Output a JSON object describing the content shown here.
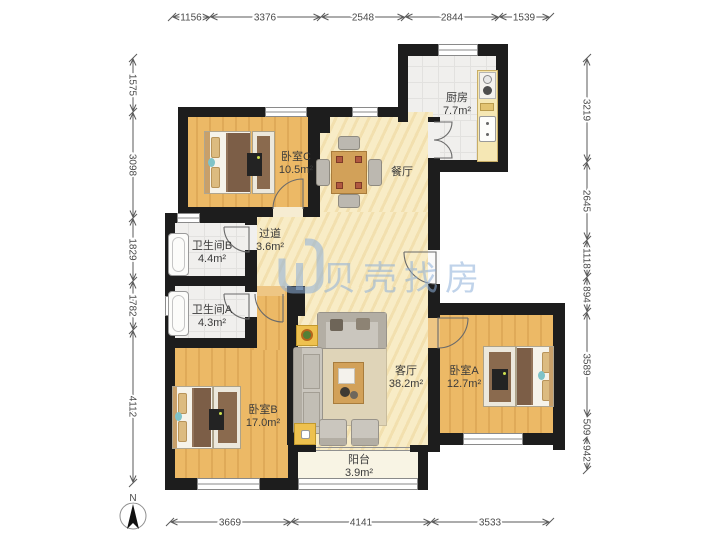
{
  "watermark": {
    "text": "贝壳找房"
  },
  "compass": {
    "label": "N"
  },
  "rooms": {
    "bedroomC": {
      "name": "卧室C",
      "area": "10.5m²"
    },
    "kitchen": {
      "name": "厨房",
      "area": "7.7m²"
    },
    "dining": {
      "name": "餐厅"
    },
    "hallway": {
      "name": "过道",
      "area": "3.6m²"
    },
    "bathroomB": {
      "name": "卫生间B",
      "area": "4.4m²"
    },
    "bathroomA": {
      "name": "卫生间A",
      "area": "4.3m²"
    },
    "bedroomB": {
      "name": "卧室B",
      "area": "17.0m²"
    },
    "living": {
      "name": "客厅",
      "area": "38.2m²"
    },
    "bedroomA": {
      "name": "卧室A",
      "area": "12.7m²"
    },
    "balcony": {
      "name": "阳台",
      "area": "3.9m²"
    }
  },
  "dimensions": {
    "top": [
      "1156",
      "3376",
      "2548",
      "2844",
      "1539"
    ],
    "bottom": [
      "3669",
      "4141",
      "3533"
    ],
    "left": [
      "1575",
      "3098",
      "1829",
      "1782",
      "4112"
    ],
    "right": [
      "3219",
      "2645",
      "1118",
      "894",
      "3589",
      "509",
      "942"
    ]
  },
  "colors": {
    "wall": "#1d1d1d",
    "wood_floor": "#ecb966",
    "open_floor": "#f8ecc6",
    "tile_floor": "#f0efed",
    "watermark_blue": "#8cafd8"
  }
}
